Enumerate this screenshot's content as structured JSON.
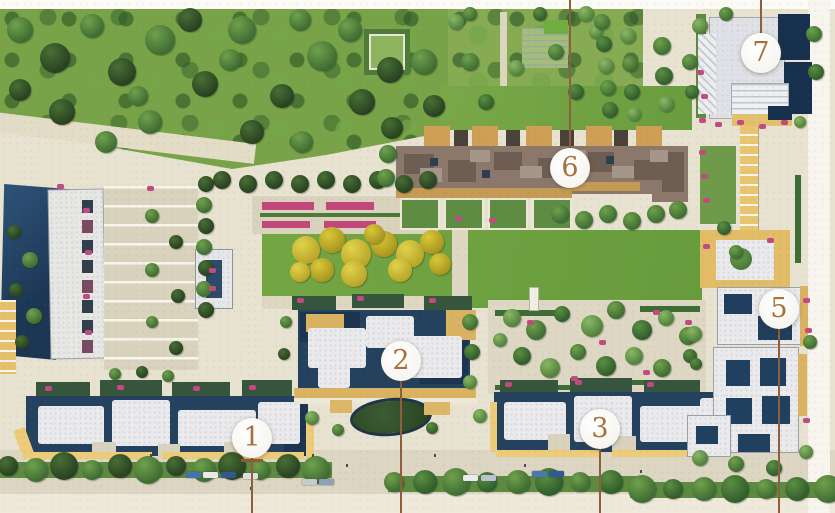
{
  "site_plan": {
    "markers": [
      {
        "label": "1",
        "x": 252,
        "y": 438,
        "leader": "down"
      },
      {
        "label": "2",
        "x": 401,
        "y": 361,
        "leader": "down"
      },
      {
        "label": "3",
        "x": 600,
        "y": 429,
        "leader": "down"
      },
      {
        "label": "5",
        "x": 779,
        "y": 309,
        "leader": "down"
      },
      {
        "label": "6",
        "x": 570,
        "y": 168,
        "leader": "up"
      },
      {
        "label": "7",
        "x": 761,
        "y": 53,
        "leader": "up"
      }
    ],
    "marker_style": {
      "number_color": "#a8713c",
      "circle_color": "#ffffff",
      "leader_line_color": "#8e5f3c"
    }
  }
}
